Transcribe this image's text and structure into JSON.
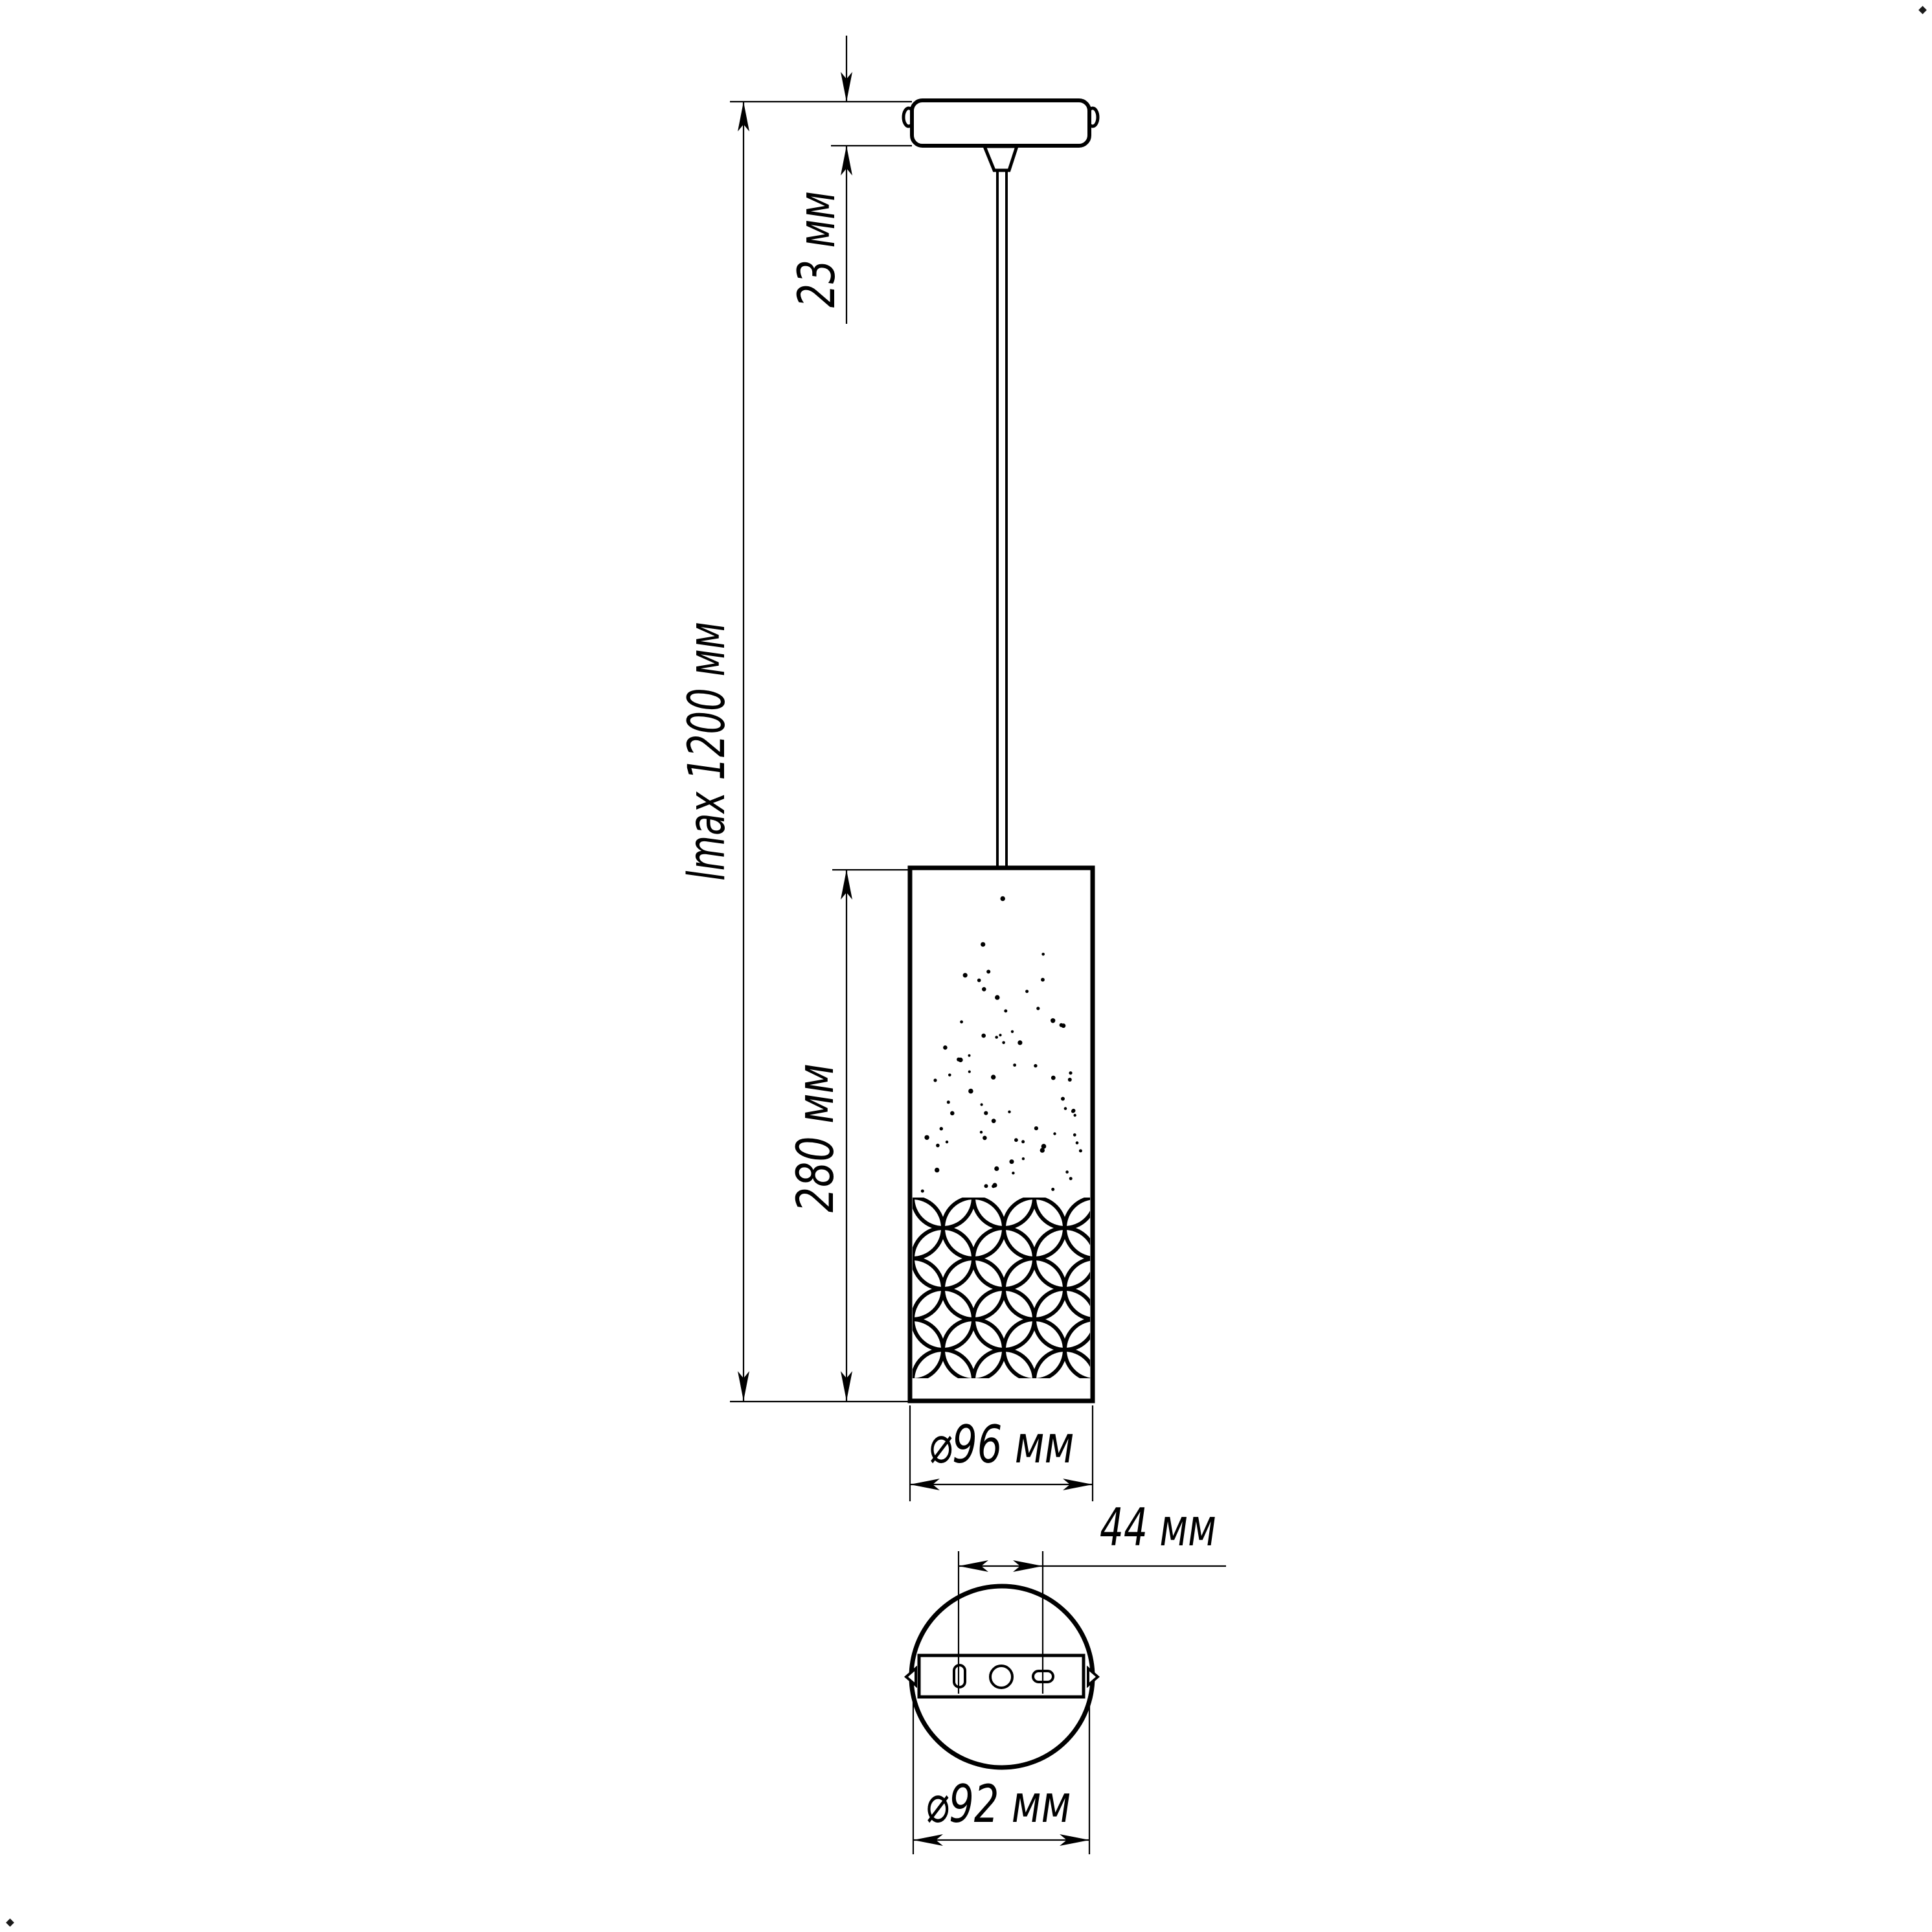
{
  "page": {
    "background": "#ffffff",
    "ink": "#000000"
  },
  "drawing": {
    "kind": "pendant-lamp dimensional drawing",
    "views": {
      "front": "ceiling canopy with suspension wire and cylindrical perforated shade",
      "bottom": "canopy bottom view with mounting bar, screws and holes"
    },
    "labels": {
      "canopy_height": "23 мм",
      "max_length": "lmax 1200 мм",
      "shade_height": "280 мм",
      "shade_diameter": "⌀96 мм",
      "hole_spacing": "44 мм",
      "canopy_diameter": "⌀92 мм"
    },
    "values_mm": {
      "canopy_height": 23,
      "max_length": 1200,
      "shade_height": 280,
      "shade_diameter": 96,
      "hole_spacing": 44,
      "canopy_diameter": 92
    }
  }
}
